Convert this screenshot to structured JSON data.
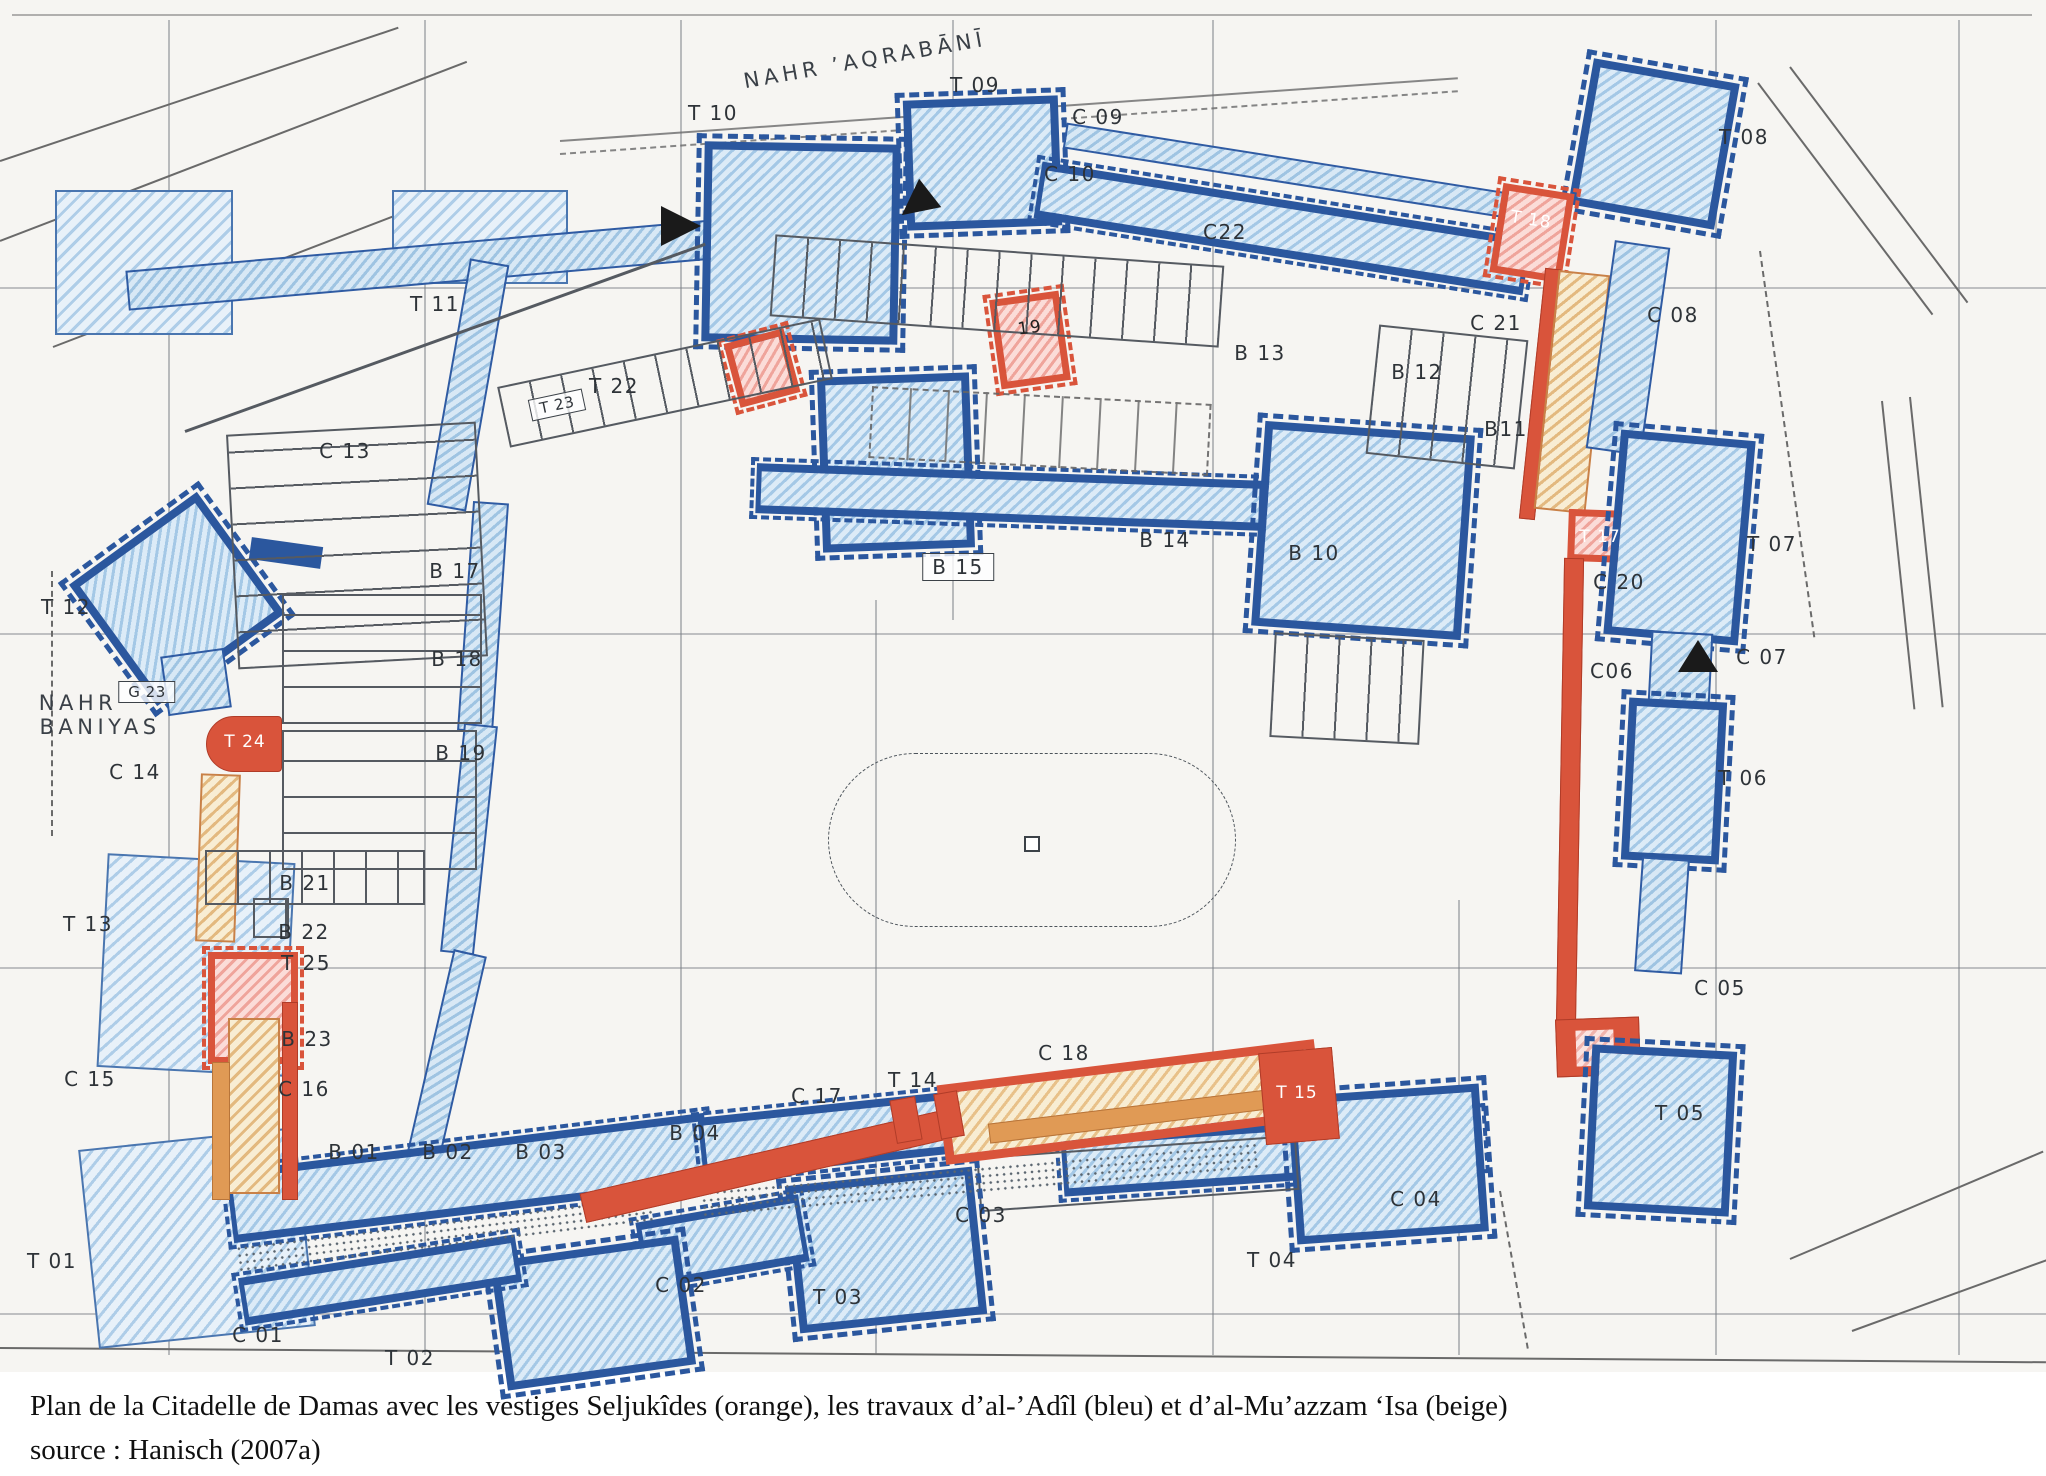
{
  "palette": {
    "seljuk_orange": "#d9543b",
    "adil_blue": "#2b579e",
    "muazzam_beige": "#f8edd3",
    "light_blue_hatch": "#dcebf7",
    "map_line": "#555a61",
    "paper": "#f6f5f2"
  },
  "caption": {
    "line1": "Plan de la Citadelle de Damas avec les vestiges Seljukîdes (orange), les travaux d’al-’Adîl (bleu) et d’al-Mu’azzam ‘Isa (beige)",
    "line2": "source : Hanisch (2007a)"
  },
  "map": {
    "labels": [
      {
        "id": "nahr-aqrabani",
        "t": "NAHR ’AQRABĀNĪ",
        "x": 865,
        "y": 60,
        "cls": "river",
        "rot": -10
      },
      {
        "id": "t10",
        "t": "T 10",
        "x": 713,
        "y": 113
      },
      {
        "id": "t09",
        "t": "T 09",
        "x": 975,
        "y": 85
      },
      {
        "id": "c09",
        "t": "C 09",
        "x": 1098,
        "y": 117
      },
      {
        "id": "t08",
        "t": "T 08",
        "x": 1744,
        "y": 137
      },
      {
        "id": "c10",
        "t": "C 10",
        "x": 1070,
        "y": 174
      },
      {
        "id": "c22",
        "t": "C22",
        "x": 1225,
        "y": 232
      },
      {
        "id": "t18",
        "t": "T 18",
        "x": 1531,
        "y": 220,
        "cls": "white",
        "rot": 9
      },
      {
        "id": "c08",
        "t": "C 08",
        "x": 1673,
        "y": 315
      },
      {
        "id": "c21",
        "t": "C 21",
        "x": 1496,
        "y": 323
      },
      {
        "id": "t11",
        "t": "T 11",
        "x": 435,
        "y": 304
      },
      {
        "id": "b13",
        "t": "B 13",
        "x": 1260,
        "y": 353
      },
      {
        "id": "b12",
        "t": "B 12",
        "x": 1417,
        "y": 372
      },
      {
        "id": "t22",
        "t": "T 22",
        "x": 614,
        "y": 386
      },
      {
        "id": "t23",
        "t": "T 23",
        "x": 557,
        "y": 405,
        "cls": "sm box",
        "rot": -12
      },
      {
        "id": "t19",
        "t": "19",
        "x": 1030,
        "y": 328,
        "cls": "dark",
        "rot": -8
      },
      {
        "id": "b11",
        "t": "B11",
        "x": 1506,
        "y": 429
      },
      {
        "id": "c13",
        "t": "C 13",
        "x": 345,
        "y": 451
      },
      {
        "id": "b14",
        "t": "B 14",
        "x": 1165,
        "y": 540
      },
      {
        "id": "b10",
        "t": "B 10",
        "x": 1314,
        "y": 553
      },
      {
        "id": "t17",
        "t": "T 17",
        "x": 1600,
        "y": 537,
        "cls": "white"
      },
      {
        "id": "c20",
        "t": "C 20",
        "x": 1619,
        "y": 582
      },
      {
        "id": "t07",
        "t": "T 07",
        "x": 1772,
        "y": 544
      },
      {
        "id": "b17",
        "t": "B 17",
        "x": 455,
        "y": 571
      },
      {
        "id": "b15",
        "t": "B 15",
        "x": 958,
        "y": 567,
        "cls": "box"
      },
      {
        "id": "t12",
        "t": "T 12",
        "x": 66,
        "y": 607
      },
      {
        "id": "b18",
        "t": "B 18",
        "x": 457,
        "y": 659
      },
      {
        "id": "g23",
        "t": "G 23",
        "x": 147,
        "y": 692,
        "cls": "sm box"
      },
      {
        "id": "c06",
        "t": "C06",
        "x": 1612,
        "y": 671
      },
      {
        "id": "c07",
        "t": "C 07",
        "x": 1762,
        "y": 657
      },
      {
        "id": "nahr-baniyas-1",
        "t": "NAHR",
        "x": 78,
        "y": 703,
        "cls": "river"
      },
      {
        "id": "nahr-baniyas-2",
        "t": "BANIYAS",
        "x": 100,
        "y": 727,
        "cls": "river"
      },
      {
        "id": "t24",
        "t": "T 24",
        "x": 245,
        "y": 742,
        "cls": "white"
      },
      {
        "id": "b19",
        "t": "B 19",
        "x": 461,
        "y": 753
      },
      {
        "id": "c14",
        "t": "C 14",
        "x": 135,
        "y": 772
      },
      {
        "id": "t06",
        "t": "T 06",
        "x": 1743,
        "y": 778
      },
      {
        "id": "b21",
        "t": "B 21",
        "x": 305,
        "y": 883
      },
      {
        "id": "t13",
        "t": "T 13",
        "x": 88,
        "y": 924
      },
      {
        "id": "b22",
        "t": "B 22",
        "x": 304,
        "y": 932
      },
      {
        "id": "t25",
        "t": "T 25",
        "x": 306,
        "y": 963
      },
      {
        "id": "c05",
        "t": "C 05",
        "x": 1720,
        "y": 988
      },
      {
        "id": "b23",
        "t": "B 23",
        "x": 307,
        "y": 1039
      },
      {
        "id": "c15",
        "t": "C 15",
        "x": 90,
        "y": 1079
      },
      {
        "id": "c16",
        "t": "C 16",
        "x": 304,
        "y": 1089
      },
      {
        "id": "c18",
        "t": "C 18",
        "x": 1064,
        "y": 1053
      },
      {
        "id": "t14",
        "t": "T 14",
        "x": 913,
        "y": 1080
      },
      {
        "id": "c17",
        "t": "C 17",
        "x": 817,
        "y": 1096
      },
      {
        "id": "t15",
        "t": "T 15",
        "x": 1297,
        "y": 1093,
        "cls": "white"
      },
      {
        "id": "t05",
        "t": "T 05",
        "x": 1680,
        "y": 1113
      },
      {
        "id": "b04",
        "t": "B 04",
        "x": 695,
        "y": 1133
      },
      {
        "id": "b01",
        "t": "B 01",
        "x": 354,
        "y": 1152
      },
      {
        "id": "b02",
        "t": "B 02",
        "x": 448,
        "y": 1152
      },
      {
        "id": "b03",
        "t": "B 03",
        "x": 541,
        "y": 1152
      },
      {
        "id": "c04",
        "t": "C 04",
        "x": 1416,
        "y": 1199
      },
      {
        "id": "c03",
        "t": "C 03",
        "x": 981,
        "y": 1215
      },
      {
        "id": "t01",
        "t": "T 01",
        "x": 52,
        "y": 1261
      },
      {
        "id": "t04",
        "t": "T 04",
        "x": 1272,
        "y": 1260
      },
      {
        "id": "c02",
        "t": "C 02",
        "x": 681,
        "y": 1285
      },
      {
        "id": "t03",
        "t": "T 03",
        "x": 838,
        "y": 1297
      },
      {
        "id": "c01",
        "t": "C 01",
        "x": 258,
        "y": 1335
      },
      {
        "id": "t02",
        "t": "T 02",
        "x": 410,
        "y": 1358
      }
    ]
  }
}
